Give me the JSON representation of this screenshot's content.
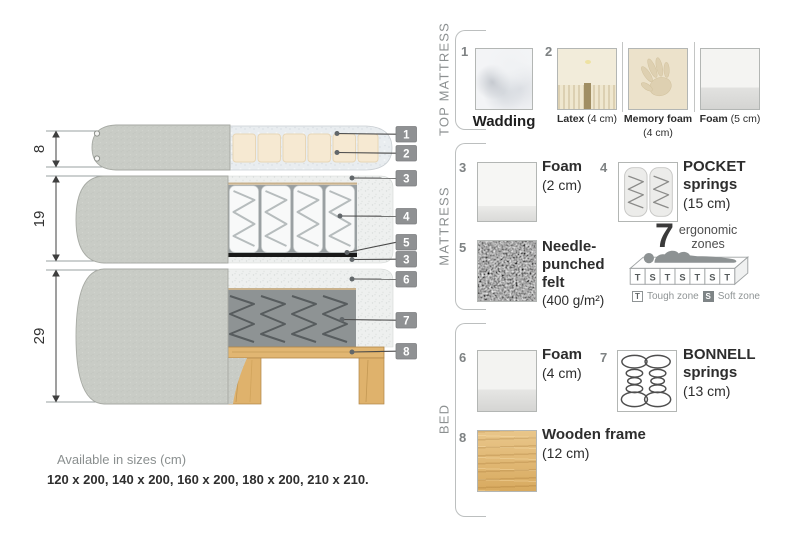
{
  "diagram": {
    "dims": [
      "8",
      "19",
      "29"
    ],
    "callouts": [
      "1",
      "2",
      "3",
      "4",
      "5",
      "3",
      "6",
      "7",
      "8"
    ]
  },
  "panel": {
    "sections": [
      {
        "label": "TOP MATTRESS",
        "items": [
          {
            "num": "1",
            "name": "Wadding",
            "size": ""
          },
          {
            "num": "2",
            "name": "Latex",
            "size": "(4 cm)"
          },
          {
            "num": "",
            "name": "Memory foam",
            "size": "(4 cm)"
          },
          {
            "num": "",
            "name": "Foam",
            "size": "(5 cm)"
          }
        ]
      },
      {
        "label": "MATTRESS",
        "items": [
          {
            "num": "3",
            "name": "Foam",
            "size": "(2 cm)"
          },
          {
            "num": "4",
            "name": "POCKET springs",
            "size": "(15 cm)"
          },
          {
            "num": "5",
            "name": "Needle-punched felt",
            "size": "(400 g/m²)"
          }
        ],
        "ergonomic": {
          "big": "7",
          "word1": "ergonomic",
          "word2": "zones",
          "zones": [
            "T",
            "S",
            "T",
            "S",
            "T",
            "S",
            "T"
          ],
          "legendT": "T",
          "legendTLabel": "Tough zone",
          "legendS": "S",
          "legendSLabel": "Soft zone"
        }
      },
      {
        "label": "BED",
        "items": [
          {
            "num": "6",
            "name": "Foam",
            "size": "(4 cm)"
          },
          {
            "num": "7",
            "name": "BONNELL springs",
            "size": "(13 cm)"
          },
          {
            "num": "8",
            "name": "Wooden frame",
            "size": "(12 cm)"
          }
        ]
      }
    ]
  },
  "footer": {
    "heading": "Available in sizes (cm)",
    "sizes": "120 x 200, 140 x 200, 160 x 200, 180 x 200, 210 x 210."
  },
  "colors": {
    "callout_box": "#8f9193",
    "fabric_gray": "#c9ccc6",
    "wood": "#e1b672",
    "cream_foam": "#f6e9d2",
    "label_gray": "#8c9091",
    "text_dark": "#2d2d2d"
  }
}
